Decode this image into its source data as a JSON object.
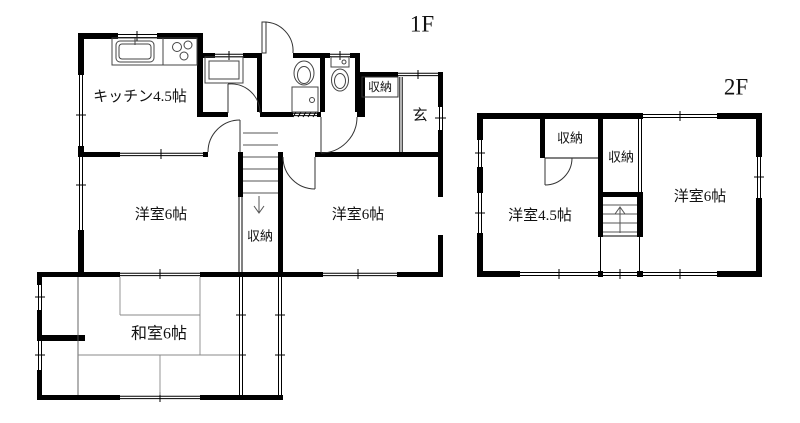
{
  "floors": {
    "f1": {
      "label": "1F",
      "rooms": {
        "kitchen": "キッチン4.5帖",
        "western_left": "洋室6帖",
        "western_right": "洋室6帖",
        "japanese": "和室6帖",
        "stairs_storage": "収納",
        "entrance_storage": "収納",
        "entrance": "玄"
      }
    },
    "f2": {
      "label": "2F",
      "rooms": {
        "western_45": "洋室4.5帖",
        "western_6": "洋室6帖",
        "storage_a": "収納",
        "storage_b": "収納"
      }
    }
  },
  "colors": {
    "wall": "#000000",
    "thin_line": "#333333",
    "tatami_line": "#888888",
    "background": "#ffffff"
  }
}
